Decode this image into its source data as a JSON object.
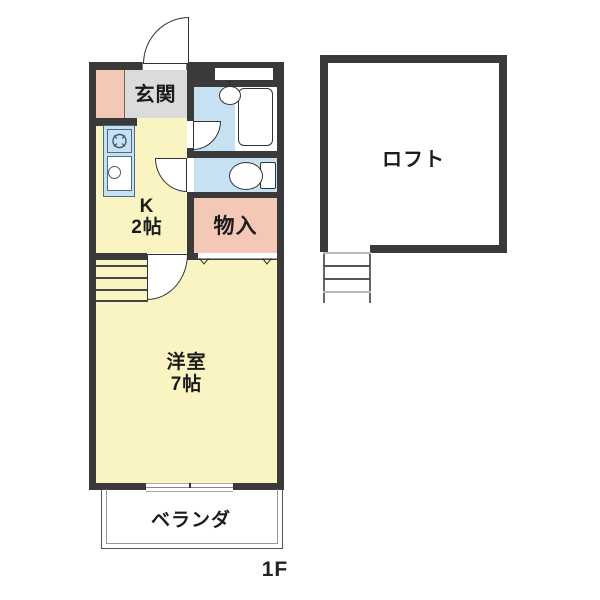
{
  "floor_plan": {
    "floor_label": "1F",
    "rooms": {
      "genkan": {
        "label": "玄関"
      },
      "kitchen": {
        "label": "K",
        "size": "2帖"
      },
      "storage": {
        "label": "物入"
      },
      "western_room": {
        "label": "洋室",
        "size": "7帖"
      },
      "veranda": {
        "label": "ベランダ"
      },
      "loft": {
        "label": "ロフト"
      }
    },
    "icons": {
      "stove-icon": "burner circle with tick marks",
      "kitchen-sink-icon": "rectangle with drain circle",
      "washbasin-icon": "oval basin with tap",
      "bathtub-icon": "rounded rectangle tub",
      "toilet-icon": "bowl oval with tank",
      "stairs-icon": "parallel step lines",
      "ladder-icon": "two rails with rungs",
      "door-arc-icon": "quarter-circle swing"
    },
    "palette": {
      "wall": "#3a3a3a",
      "room_yellow": "#faf4c3",
      "room_pink": "#f3c8b7",
      "room_blue": "#c6e1f2",
      "room_gray": "#dbdbdb",
      "line": "#333333",
      "background": "#ffffff"
    }
  }
}
